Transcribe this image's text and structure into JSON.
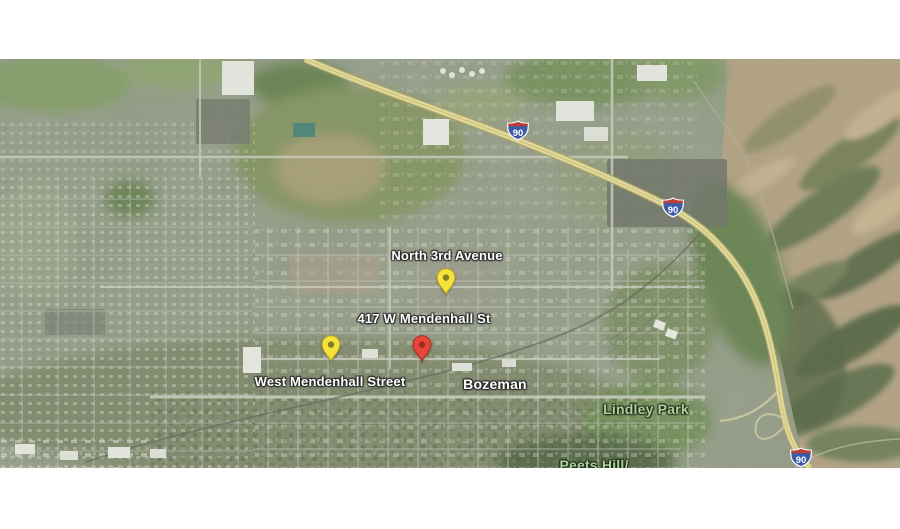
{
  "map": {
    "description": "satellite map of Bozeman, Montana with address markers",
    "labels": {
      "north_3rd_avenue": "North 3rd Avenue",
      "address_417": "417 W Mendenhall St",
      "west_mendenhall": "West Mendenhall Street",
      "city": "Bozeman",
      "lindley_park": "Lindley Park",
      "peets_hill": "Peets Hill/"
    },
    "markers": [
      {
        "id": "north-3rd-avenue-pin",
        "shape": "map-pin",
        "color": "#f6e23a",
        "dot_color": "#837c20",
        "outline_color": "#b9a825"
      },
      {
        "id": "417-w-mendenhall-st-pin",
        "shape": "map-pin",
        "color": "#e8463a",
        "dot_color": "#9b2a21",
        "outline_color": "#a62c22"
      },
      {
        "id": "west-mendenhall-street-pin",
        "shape": "map-pin",
        "color": "#f6e23a",
        "dot_color": "#837c20",
        "outline_color": "#b9a825"
      }
    ],
    "shields": [
      {
        "id": "i90-shield-upper",
        "label": "90"
      },
      {
        "id": "i90-shield-middle",
        "label": "90"
      },
      {
        "id": "i90-shield-lower",
        "label": "90"
      }
    ],
    "colors": {
      "interstate_blue": "#3b5ba5",
      "interstate_red": "#c23b2e",
      "highway_yellow": "#ebe294",
      "park_label_green": "#aed29b",
      "street_label_white": "#ffffff",
      "letterbox_white": "#ffffff"
    }
  }
}
